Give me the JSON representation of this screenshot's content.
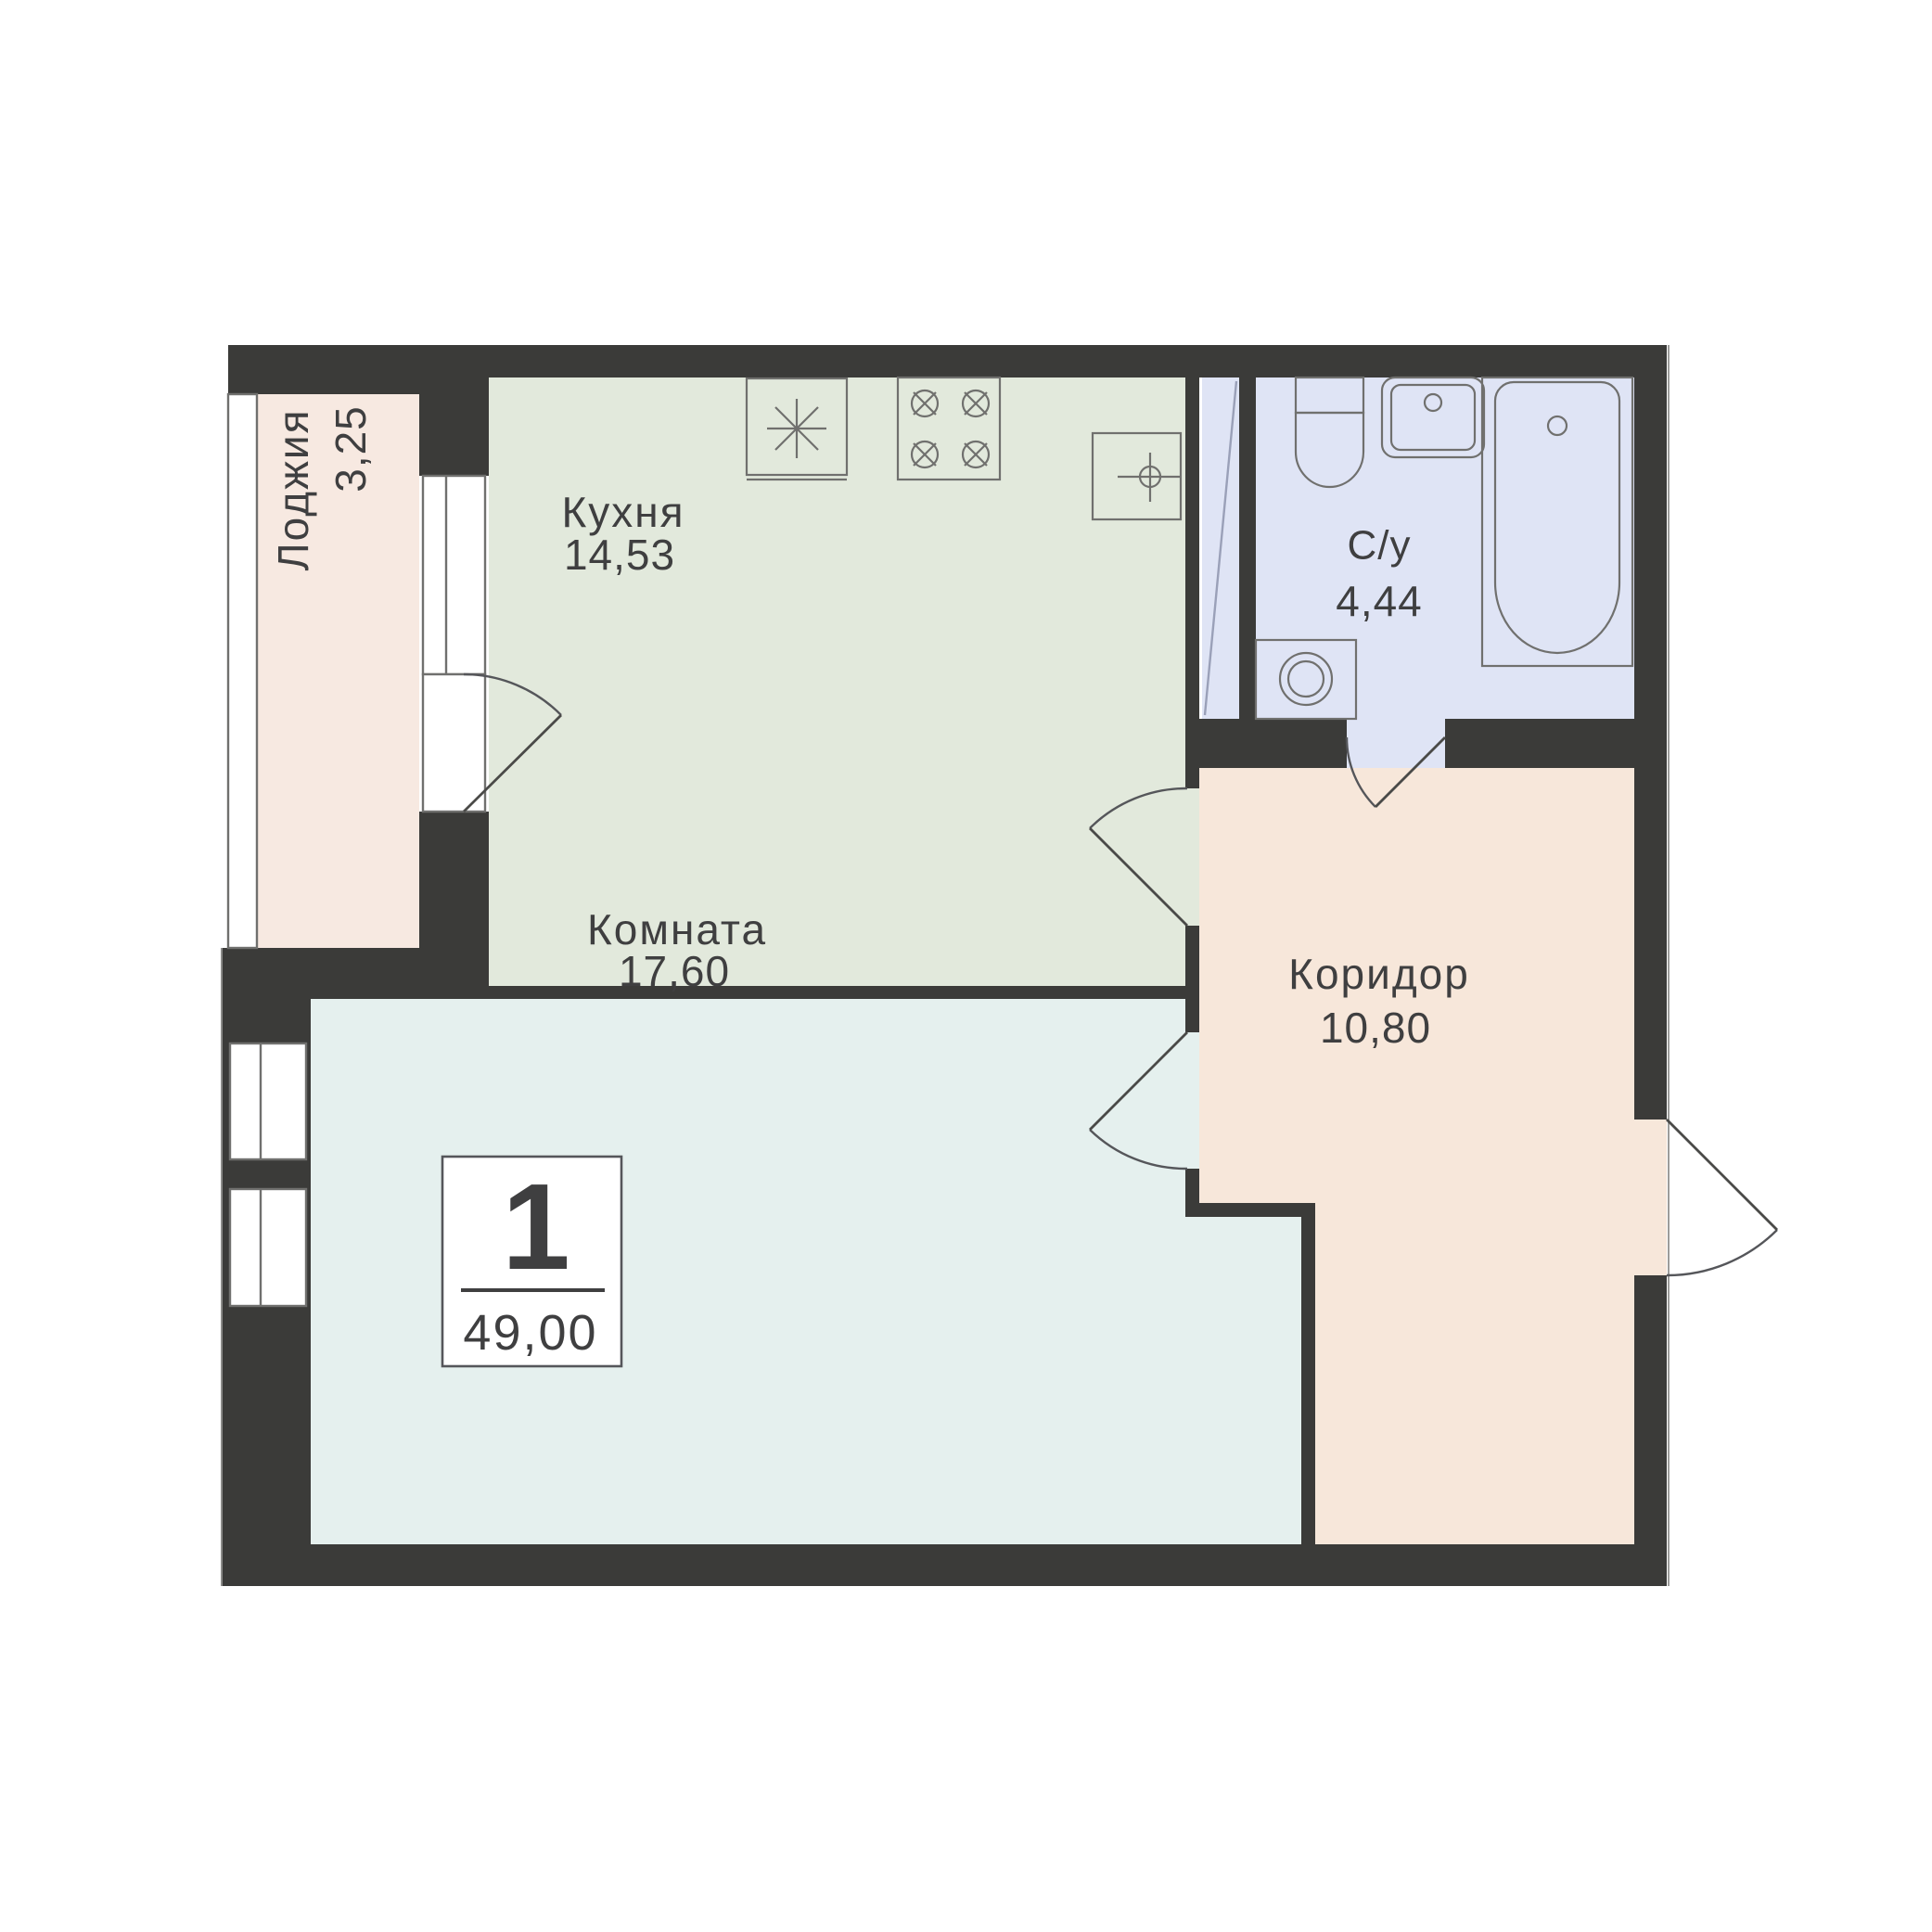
{
  "plan": {
    "badge": {
      "rooms_count": "1",
      "total_area": "49,00"
    },
    "rooms": [
      {
        "id": "loggia",
        "label": "Лоджия",
        "area": "3,25"
      },
      {
        "id": "kitchen",
        "label": "Кухня",
        "area": "14,53"
      },
      {
        "id": "bathroom",
        "label": "С/у",
        "area": "4,44"
      },
      {
        "id": "corridor",
        "label": "Коридор",
        "area": "10,80"
      },
      {
        "id": "room",
        "label": "Комната",
        "area": "17,60"
      }
    ],
    "colors": {
      "wall": "#3b3b39",
      "loggia_fill": "#f7e9e1",
      "kitchen_fill": "#e2e9dc",
      "room_fill": "#e5f0ee",
      "corridor_fill": "#f7e7da",
      "bathroom_fill": "#dfe4f5",
      "line": "#70706e",
      "text": "#3f3f40"
    },
    "fixtures": [
      "fridge-icon",
      "stove-icon",
      "kitchen-sink-icon",
      "toilet-icon",
      "washbasin-icon",
      "bathtub-icon",
      "washing-machine-icon",
      "vent-shaft-icon"
    ]
  }
}
